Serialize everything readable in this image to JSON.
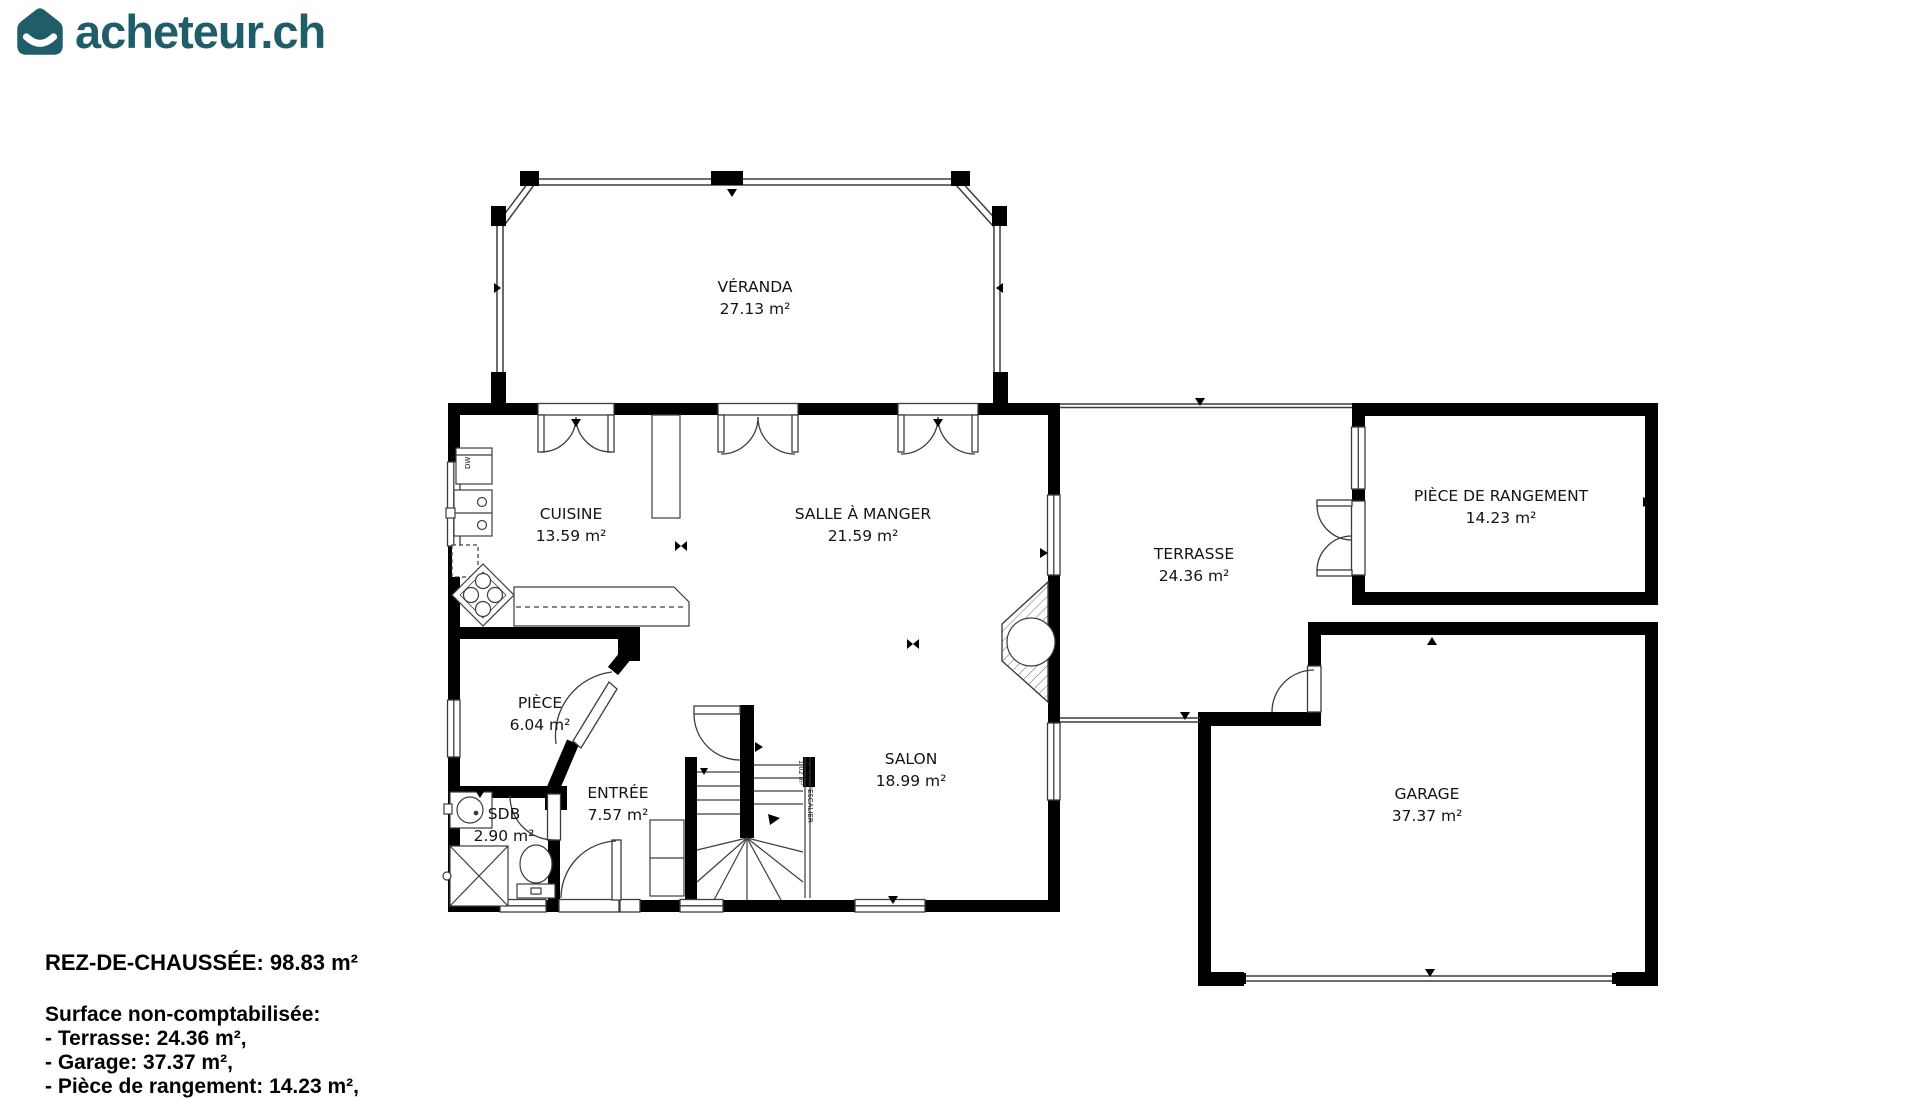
{
  "logo": {
    "text": "acheteur.ch",
    "brand_color": "#1f5e69"
  },
  "rooms": {
    "veranda": {
      "name": "VÉRANDA",
      "area": "27.13 m²"
    },
    "cuisine": {
      "name": "CUISINE",
      "area": "13.59 m²"
    },
    "salle_a_manger": {
      "name": "SALLE À MANGER",
      "area": "21.59 m²"
    },
    "terrasse": {
      "name": "TERRASSE",
      "area": "24.36 m²"
    },
    "piece_de_rangement": {
      "name": "PIÈCE DE RANGEMENT",
      "area": "14.23 m²"
    },
    "piece": {
      "name": "PIÈCE",
      "area": "6.04 m²"
    },
    "salon": {
      "name": "SALON",
      "area": "18.99 m²"
    },
    "entree": {
      "name": "ENTRÉE",
      "area": "7.57 m²"
    },
    "sdb": {
      "name": "SDB",
      "area": "2.90 m²"
    },
    "garage": {
      "name": "GARAGE",
      "area": "37.37 m²"
    },
    "cage_escalier": {
      "name": "CAGE D'ESCALIER",
      "area": "1.02 m²"
    }
  },
  "labels": {
    "dishwasher": "DW"
  },
  "footer": {
    "floor_title": "REZ-DE-CHAUSSÉE: 98.83 m²",
    "note_title": "Surface non-comptabilisée:",
    "items": [
      "- Terrasse: 24.36 m²,",
      "- Garage: 37.37 m²,"
    ],
    "cutoff_item": "- Pièce de rangement: 14.23 m²,"
  }
}
